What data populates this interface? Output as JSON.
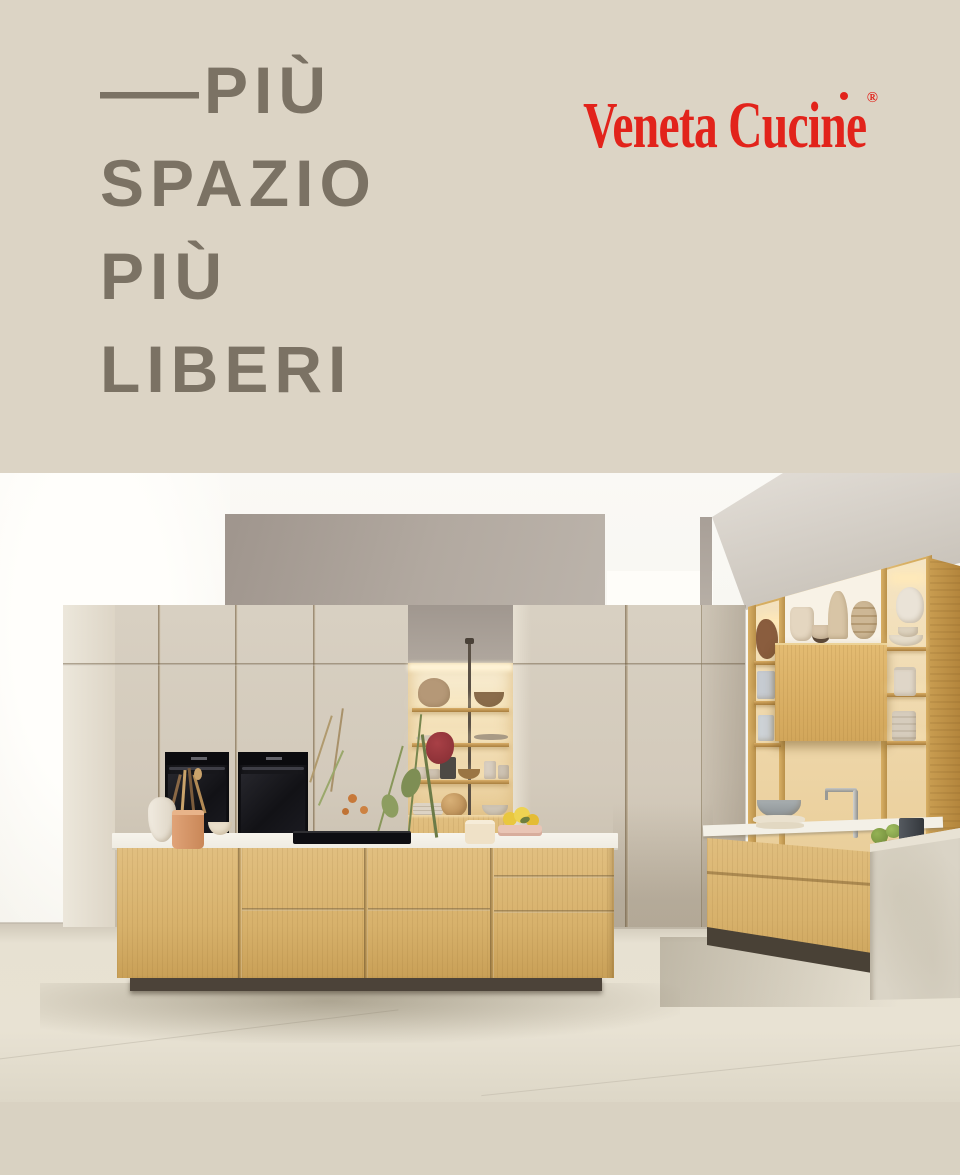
{
  "header": {
    "headline": {
      "dash": "—",
      "lines": [
        "PIÙ",
        "SPAZIO",
        "PIÙ",
        "LIBERI"
      ]
    },
    "brand": {
      "name": "Veneta Cucine",
      "registered_mark": "®"
    }
  },
  "palette": {
    "band_beige": "#dcd4c5",
    "footer_beige": "#d9d2c2",
    "headline_gray": "#7b7264",
    "brand_red": "#e2231b",
    "cabinet_beige": "#d5ccbd",
    "oak_wood": "#d7b16b",
    "gray_wall": "#aba29a",
    "floor": "#e6e0d1",
    "plinth_dark": "#4c4339"
  }
}
